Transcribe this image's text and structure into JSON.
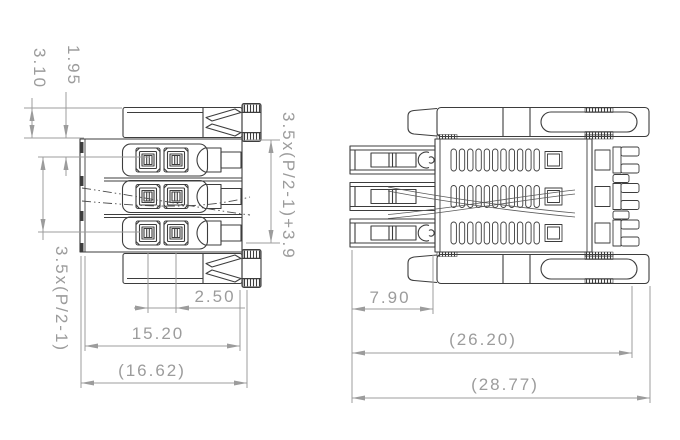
{
  "drawing": {
    "kind": "connector-technical-drawing",
    "views": [
      "front-view",
      "side-view"
    ]
  },
  "colors": {
    "background": "#ffffff",
    "part_line": "#3d3d3d",
    "dimension": "#9c9c9c"
  },
  "dims": {
    "bar_height": "3.10",
    "top_to_row1": "1.95",
    "row_span": "3.5x(P/2-1)",
    "row_span_plus": "3.5x(P/2-1)+3.9",
    "contact_pitch": "2.50",
    "body_width": "15.20",
    "overall_width": "(16.62)",
    "pin_length": "7.90",
    "body_length": "(26.20)",
    "overall_length": "(28.77)"
  }
}
